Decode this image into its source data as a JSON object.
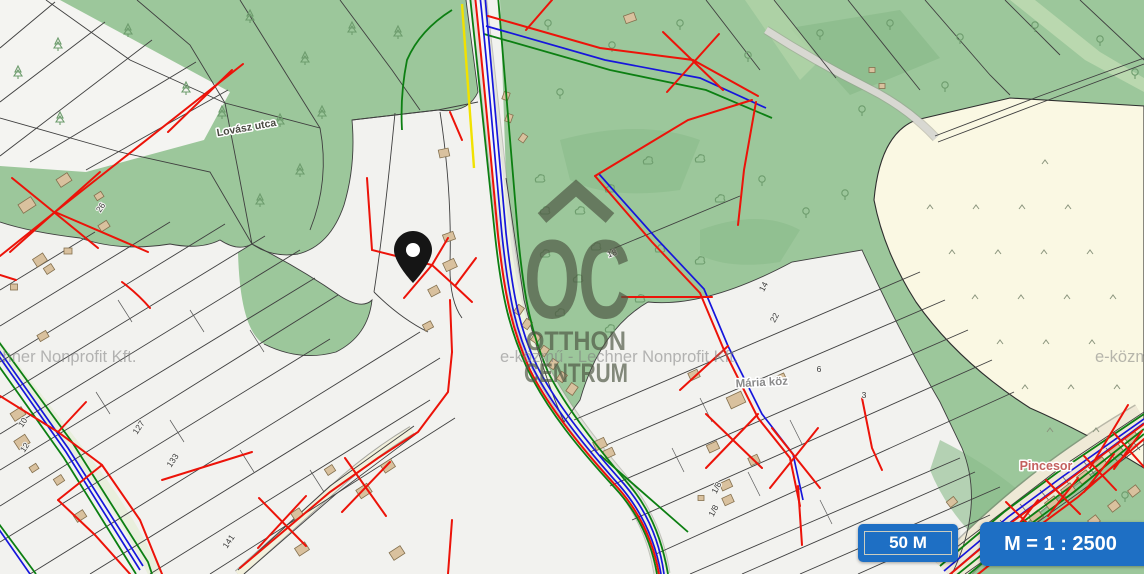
{
  "map": {
    "street_labels": [
      {
        "text": "Lovász utca"
      },
      {
        "text": "Mária köz"
      },
      {
        "text": "Pincesor"
      }
    ],
    "parcel_numbers": [
      "127",
      "133",
      "10",
      "12",
      "141",
      "26",
      "14",
      "22",
      "6",
      "3",
      "1/8",
      "1/8",
      "18"
    ],
    "watermark": {
      "brand_abbr": "OC",
      "brand_name_line1": "OTTHON",
      "brand_name_line2": "CENTRUM",
      "provider_text": "e-közmű - Lechner Nonprofit Kft."
    },
    "marker": {
      "name": "location-pin",
      "color": "#151515"
    },
    "colors": {
      "forest_green": "#9cc79b",
      "dark_forest_green": "#8abb8a",
      "orchard_cream": "#faf8e3",
      "parcel_white": "#f4f4f1",
      "road_gray": "#d8d8d2",
      "utility_red": "#ec1309",
      "utility_blue": "#1616dc",
      "utility_green": "#0c7f12",
      "utility_yellow": "#f1e200",
      "building_tan": "#d9c19e",
      "pincesor_label_color": "#c4615f"
    }
  },
  "controls": {
    "scale_bar_label": "50 M",
    "scale_ratio_label": "M = 1 : 2500",
    "button_color": "#1e6fc4"
  }
}
